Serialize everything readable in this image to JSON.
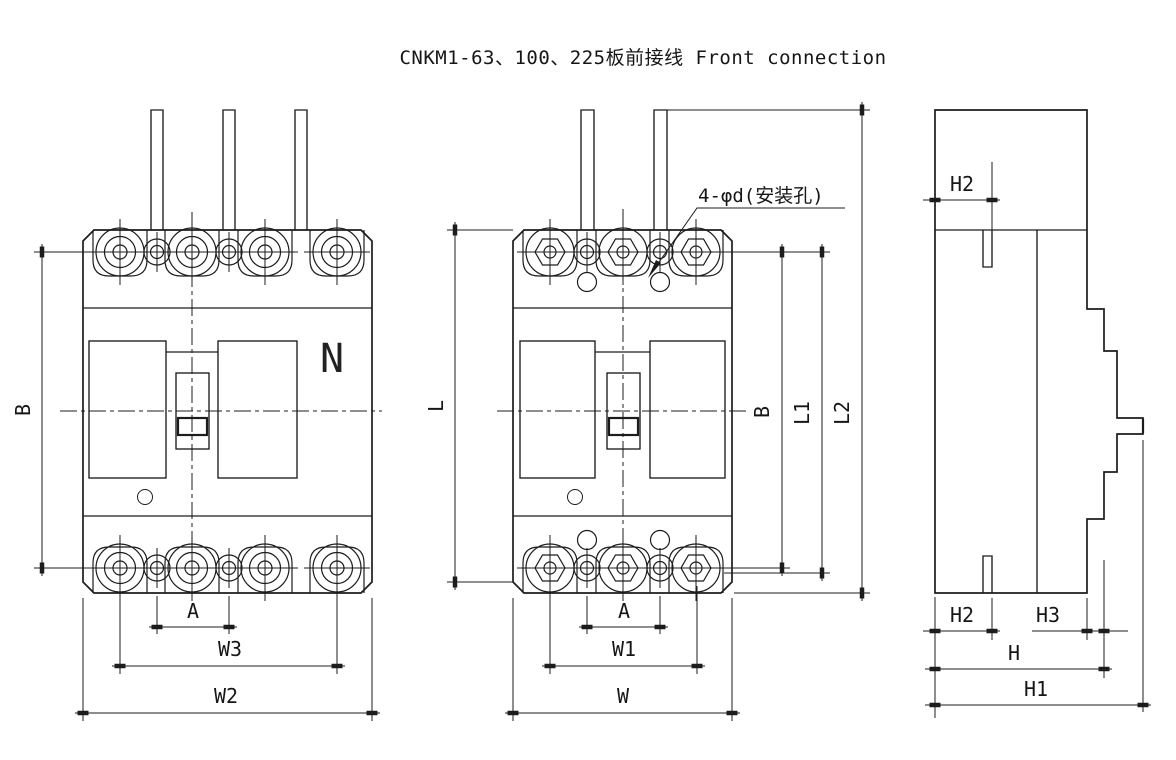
{
  "title": "CNKM1-63、100、225板前接线  Front connection",
  "colors": {
    "line": "#1c1c1c",
    "background": "#ffffff"
  },
  "views": {
    "front_4p": {
      "n_label": "N",
      "b": "B",
      "a": "A",
      "w3": "W3",
      "w2": "W2"
    },
    "front_3p": {
      "note": "4-φd(安装孔)",
      "l": "L",
      "b": "B",
      "l1": "L1",
      "l2": "L2",
      "a": "A",
      "w1": "W1",
      "w": "W"
    },
    "side": {
      "h2_top": "H2",
      "h2_bottom": "H2",
      "h3": "H3",
      "h": "H",
      "h1": "H1"
    }
  }
}
